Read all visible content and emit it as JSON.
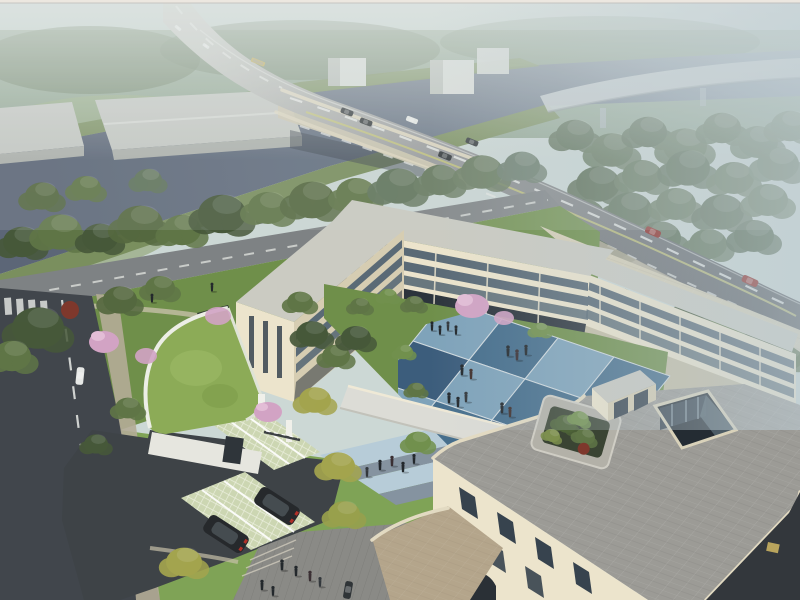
{
  "meta": {
    "title": "Aerial architectural rendering of a three-storey cream campus building with blue checkerboard courtyard, river and highway bridge",
    "image_type": "architectural aerial rendering",
    "view": "bird's-eye axonometric, hazy morning light"
  },
  "scene": {
    "sky": "hazy sky and distant misty forest",
    "river": "dark canal river crossed by a road bridge",
    "viaduct": "distant elevated viaduct in fog",
    "main_road": "arterial road with bus, cars and lane markings",
    "local_road": "riverside local road with trees",
    "street": "asphalt street with dashed centre line and crosswalk",
    "campus": "C-shaped cream building complex around a courtyard",
    "courtyard": "blue checkerboard courtyard plaza with people",
    "roof_terrace": "grey paved roof terrace with tree planter and glass atrium",
    "gatehouse": "entrance gatehouse with curved green grass roof",
    "parking": "grass-paver parking bays with two dark SUVs",
    "plaza": "front plaza with paving bands and pedestrians"
  },
  "palette": {
    "sky": "#ccd8d5",
    "distantForest": "#93a894",
    "forestMid": "#70846a",
    "treeDark": "#46583a",
    "treeMid": "#5f7546",
    "treeBright": "#71904d",
    "treeYellow": "#a3a44e",
    "treeFog": "#6e8070",
    "blossom": "#d2a3c4",
    "grassBank": "#7a8f5e",
    "lawn": "#6f8f4a",
    "lawnBright": "#7aa04f",
    "river": "#5c6677",
    "riverFar": "#8c9aa8",
    "roadGradTop": "#c5c7c1",
    "roadGradMid": "#96989a",
    "roadGradEnd": "#595c60",
    "bridgeSide": "#cfc8b2",
    "laneYellow": "#c8c878",
    "streetAsphalt": "#41464c",
    "driveway": "#3e4347",
    "sidewalk": "#b4ac97",
    "plank": "#8a8a86",
    "bandsBlue": "#b7ccd8",
    "bandsGray": "#8593a0",
    "warehouse": "#c6c9c4",
    "warehouseSide": "#aeb2ad",
    "cubeWhite": "#d8dcd8",
    "viaductDeck": "#c9d0d2",
    "creamLit": "#ece4cc",
    "creamShade": "#d6cdb2",
    "creamDeep": "#c4bba0",
    "roofLight": "#cbcbc2",
    "roofCream": "#d7cfb6",
    "terrace": "#9c9b96",
    "podium": "#b4a58b",
    "glassMid": "#5a6a76",
    "glassDark": "#37434e",
    "colonnade": "#2c343c",
    "courtLight": "#7fa3ba",
    "courtDark": "#466e8c",
    "courtDeep": "#3c5d7c",
    "greenRoof": "#8cab57",
    "paverStall": "#ccd6b2",
    "soil": "#3a4433",
    "shrubRed": "#7e382c",
    "suv": "#26292c",
    "carDark": "#2f3437",
    "carWhite": "#e6e8e6",
    "carRed": "#8e2620",
    "busWhite": "#dadcd8",
    "busYellow": "#c0a84a",
    "figure": "#23282c",
    "atriumPit": "#242c33",
    "fogTop": "#e7ecea",
    "fogRight": "#bdccd4",
    "frame": "#ece7e0"
  }
}
